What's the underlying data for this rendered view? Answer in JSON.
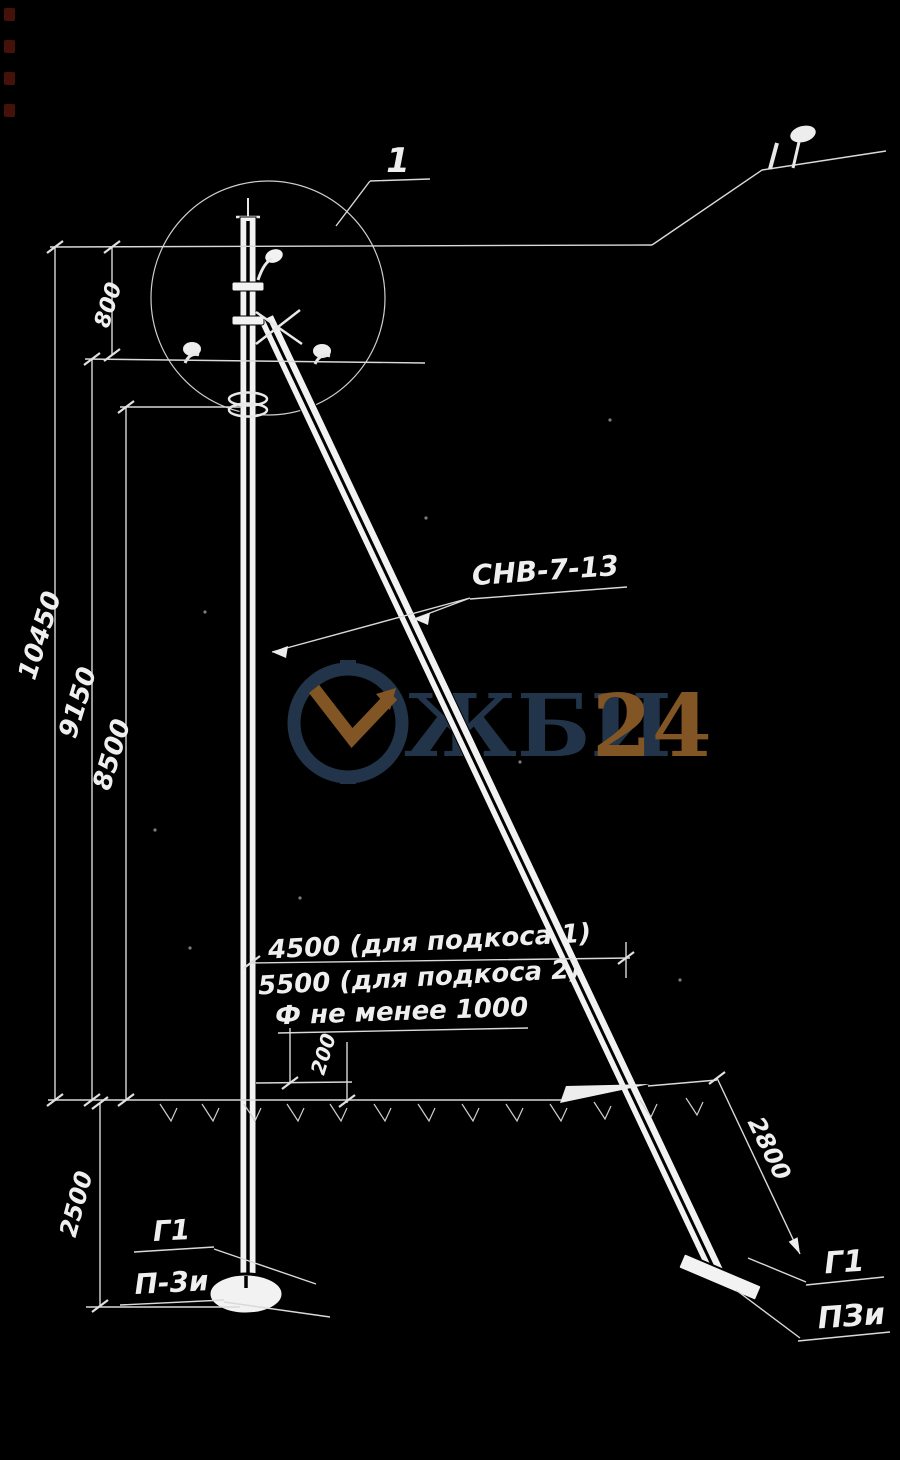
{
  "colors": {
    "background": "#000000",
    "line": "#d9d9d9",
    "ink": "#f2f2f2",
    "edge_mark_red": "#4d140c"
  },
  "watermark": {
    "brand": "ЖБИ",
    "suffix": "24",
    "navy": "#24374d",
    "orange": "#8a5a26"
  },
  "detail": {
    "callout": "1"
  },
  "part": {
    "label": "СНВ-7-13"
  },
  "dimensions": {
    "top_offset": "800",
    "total_height": "10450",
    "mid_height": "9150",
    "hook_height": "8500",
    "strut_base_1": "4500 (для подкоса 1)",
    "strut_base_2": "5500 (для подкоса 2)",
    "hole_note": "Ф не менее 1000",
    "heel_offset": "200",
    "embed_depth": "2500",
    "strut_anchor_depth": "2800"
  },
  "anchors": {
    "left": {
      "line1": "Г1",
      "line2": "П-3и"
    },
    "right": {
      "line1": "Г1",
      "line2": "ПЗи"
    }
  }
}
